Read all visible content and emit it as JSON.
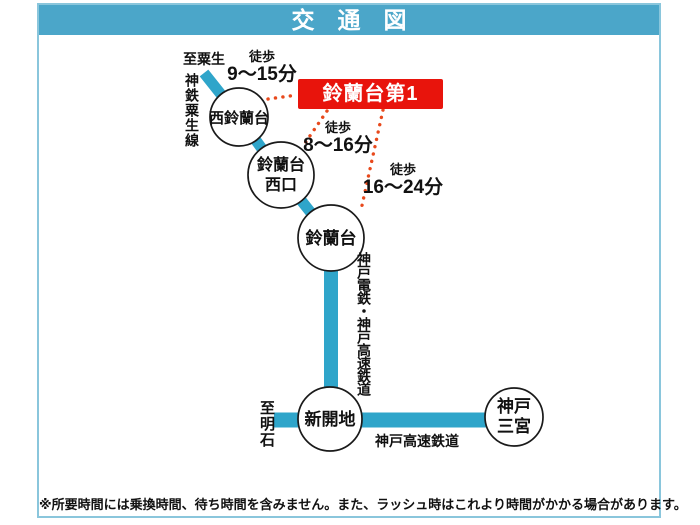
{
  "title": "交　通　図",
  "destination_box": {
    "label": "鈴蘭台第1"
  },
  "stations": [
    {
      "id": "nishi-suzurandai",
      "label": "西鈴蘭台"
    },
    {
      "id": "suzurandai-nishiguchi",
      "line1": "鈴蘭台",
      "line2": "西口"
    },
    {
      "id": "suzurandai",
      "label": "鈴蘭台"
    },
    {
      "id": "shinkaichi",
      "label": "新開地"
    },
    {
      "id": "kobe-sannomiya",
      "line1": "神戸",
      "line2": "三宮"
    }
  ],
  "walks": [
    {
      "prefix": "徒歩",
      "time": "9〜15分",
      "from": "西鈴蘭台"
    },
    {
      "prefix": "徒歩",
      "time": "8〜16分",
      "from": "鈴蘭台西口"
    },
    {
      "prefix": "徒歩",
      "time": "16〜24分",
      "from": "鈴蘭台"
    }
  ],
  "rail_labels": [
    {
      "name": "神鉄粟生線",
      "orientation": "vertical"
    },
    {
      "name": "神戸電鉄・神戸高速鉄道",
      "orientation": "vertical"
    },
    {
      "name": "神戸高速鉄道",
      "orientation": "horizontal"
    }
  ],
  "endpoints": [
    {
      "label": "至粟生"
    },
    {
      "label": "至明石"
    }
  ],
  "note": "※所要時間には乗換時間、待ち時間を含みません。また、ラッシュ時はこれより時間がかかる場合があります。",
  "colors": {
    "header": "#4BA6C9",
    "border": "#8AC6DC",
    "rail": "#2FA5CA",
    "red": "#E8140C",
    "dot": "#E8491C"
  }
}
